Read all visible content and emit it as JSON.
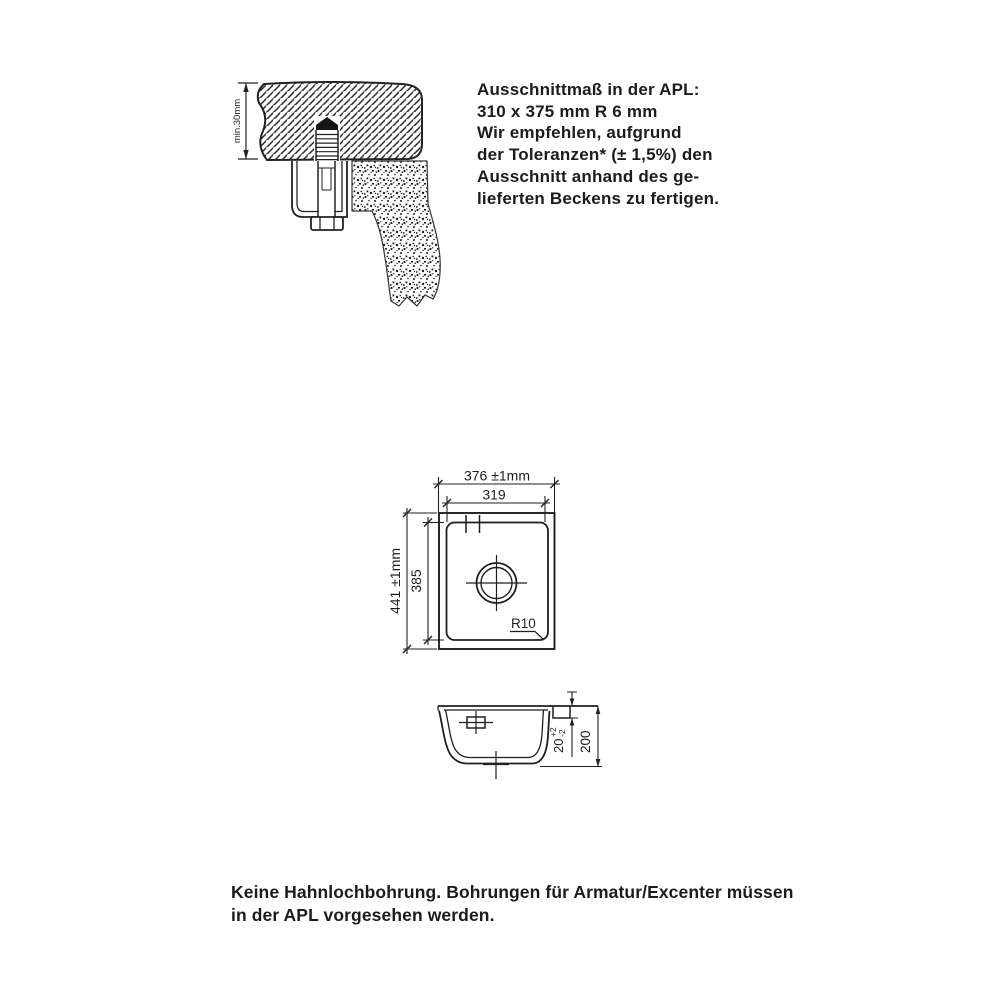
{
  "colors": {
    "ink": "#1f1f1f",
    "background": "#ffffff"
  },
  "cross_section": {
    "thickness_label": "min.30mm"
  },
  "apl_note": {
    "lines": [
      "Ausschnittmaß in der APL:",
      "310 x 375 mm R 6 mm",
      "Wir empfehlen, aufgrund",
      "der Toleranzen* (± 1,5%) den",
      "Ausschnitt anhand des ge-",
      "lieferten Beckens zu fertigen."
    ]
  },
  "top_view": {
    "outer_width": "376 ±1mm",
    "inner_width": "319",
    "outer_height": "441 ±1mm",
    "inner_height": "385",
    "corner_radius": "R10"
  },
  "side_view": {
    "rim_height": "20",
    "rim_tolerance_plus": "+2",
    "rim_tolerance_minus": "-2",
    "total_depth": "200"
  },
  "bottom_note": {
    "lines": [
      "Keine Hahnlochbohrung. Bohrungen für Armatur/Excenter müssen",
      "in der APL vorgesehen werden."
    ]
  }
}
